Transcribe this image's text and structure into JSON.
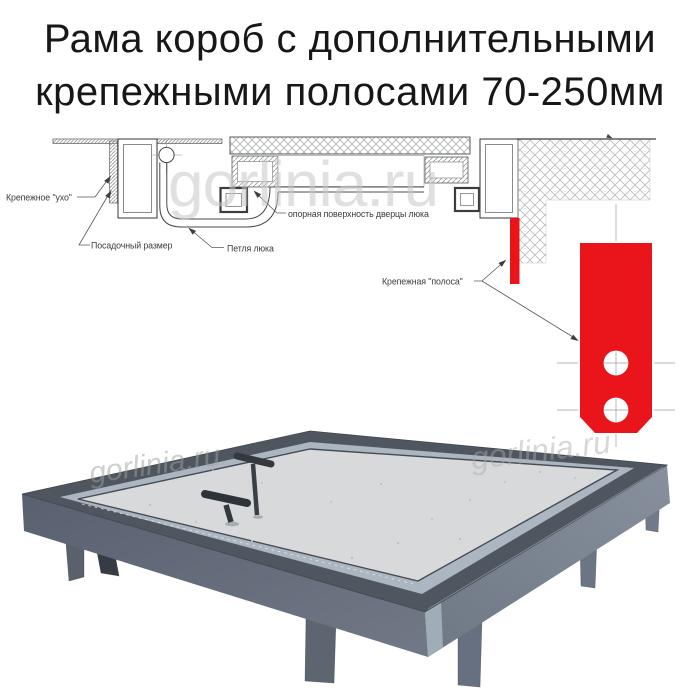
{
  "title": {
    "line1": "Рама короб с дополнительными",
    "line2": "крепежными полосами 70-250мм"
  },
  "watermark": {
    "text": "gorlinia.ru"
  },
  "diagram": {
    "labels": {
      "ear": "Крепежное \"ухо\"",
      "seat_size": "Посадочный размер",
      "hinge": "Петля люка",
      "support_surface": "опорная поверхность дверцы люка",
      "strip": "Крепежная \"полоса\""
    },
    "colors": {
      "strip_red": "#e9151b",
      "line_dark": "#4b4b4b",
      "hatch_gray": "#b7bbbb"
    }
  },
  "photo": {
    "colors": {
      "frame_gray": "#5a626e",
      "panel_gray": "#d7d9da",
      "band_gray": "#acb6c0",
      "handle_dark": "#34383f"
    }
  }
}
